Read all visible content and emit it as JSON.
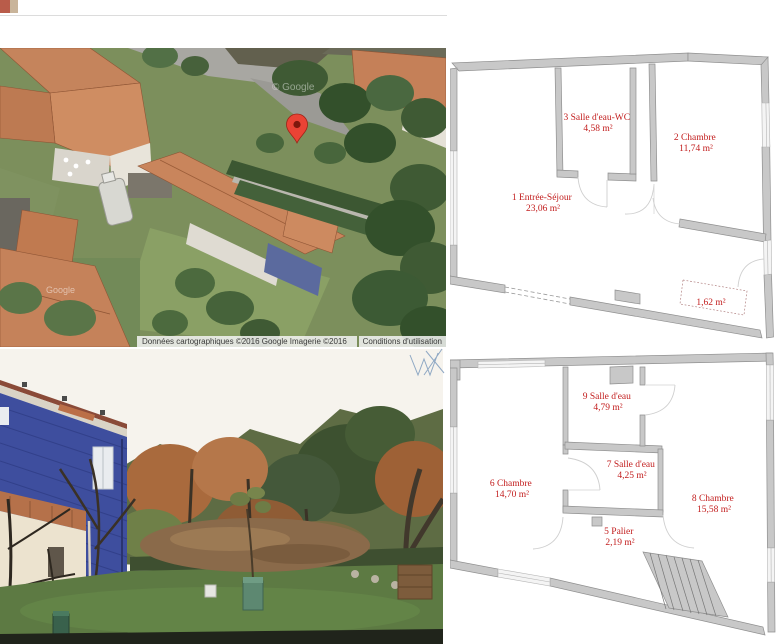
{
  "map": {
    "watermark_top": "© Google",
    "watermark_bottom": "Google",
    "attribution": {
      "left": "Données cartographiques ©2016 Google Imagerie ©2016",
      "terms": "Conditions d'utilisation"
    }
  },
  "plan_upper": {
    "rooms": {
      "entree": {
        "name": "1 Entrée-Séjour",
        "area": "23,06 m²"
      },
      "chambre2": {
        "name": "2 Chambre",
        "area": "11,74 m²"
      },
      "sde3": {
        "name": "3 Salle d'eau-WC",
        "area": "4,58 m²"
      },
      "nook": {
        "area": "1,62 m²"
      }
    }
  },
  "plan_lower": {
    "rooms": {
      "palier5": {
        "name": "5 Palier",
        "area": "2,19 m²"
      },
      "chambre6": {
        "name": "6 Chambre",
        "area": "14,70 m²"
      },
      "sde7": {
        "name": "7 Salle d'eau",
        "area": "4,25 m²"
      },
      "chambre8": {
        "name": "8 Chambre",
        "area": "15,58 m²"
      },
      "sde9": {
        "name": "9 Salle d'eau",
        "area": "4,79 m²"
      }
    }
  },
  "colors": {
    "plan_label": "#c21d1d",
    "plan_wall": "#c8c8c8",
    "pin": "#ea4335"
  }
}
